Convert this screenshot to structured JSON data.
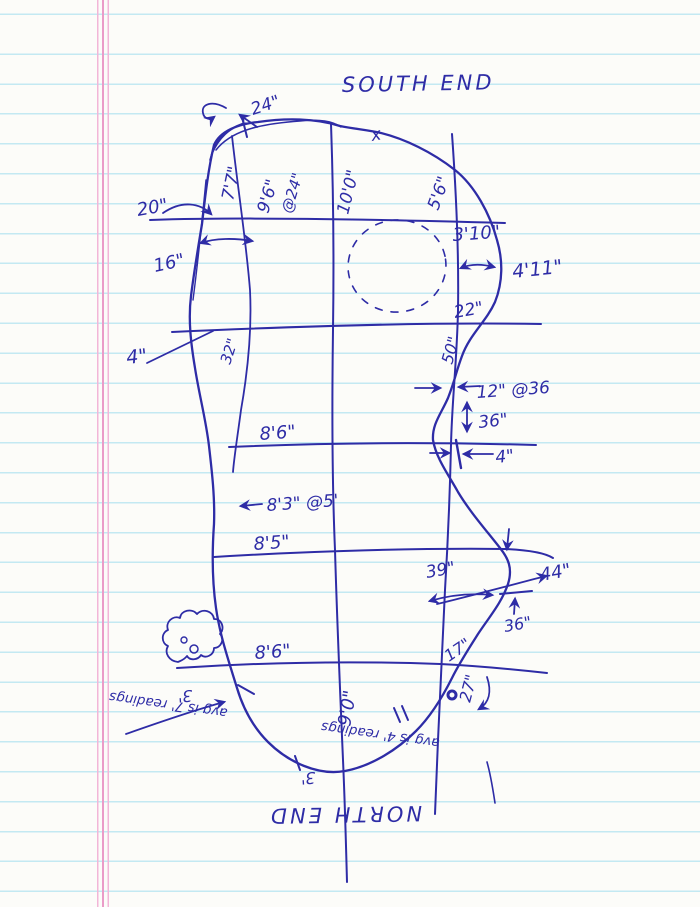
{
  "title": "Hand-drawn pond measurement sketch on ruled notebook paper",
  "colors": {
    "pen": "#2e2ca6",
    "rule_blue": "#c3e9f2",
    "margin_pink": "#ea9cc8",
    "paper": "#fcfcf9"
  },
  "labels": {
    "south_end": "SOUTH END",
    "north_end": "NORTH END",
    "x_mark": "x",
    "corner_24": "24\"",
    "depth_7_7": "7'7\"",
    "depth_9_6": "9'6\"",
    "at_24": "@24\"",
    "width_10_0": "10'0\"",
    "depth_5_6": "5'6\"",
    "offset_20": "20\"",
    "width_3_10": "3'10\"",
    "width_4_11": "4'11\"",
    "gap_16": "16\"",
    "width_22": "22\"",
    "offset_4_left": "4\"",
    "len_32": "32\"",
    "len_50": "50\"",
    "narrow_12_at_36": "12\" @36",
    "drop_36": "36\"",
    "width_8_6_upper": "8'6\"",
    "gap_4_right": "4\"",
    "width_8_3_at_5": "8'3\" @5'",
    "width_8_5": "8'5\"",
    "len_39": "39\"",
    "len_44": "44\"",
    "depth_36_lower": "36\"",
    "width_8_6_lower": "8'6\"",
    "len_17": "17\"",
    "depth_3_left": "3'",
    "depth_3_bottom": "3'",
    "len_27": "27\"",
    "width_9_0": "9'0\"",
    "note_curve": "avg is 4' readings",
    "note_left": "avg is 7' readings"
  }
}
